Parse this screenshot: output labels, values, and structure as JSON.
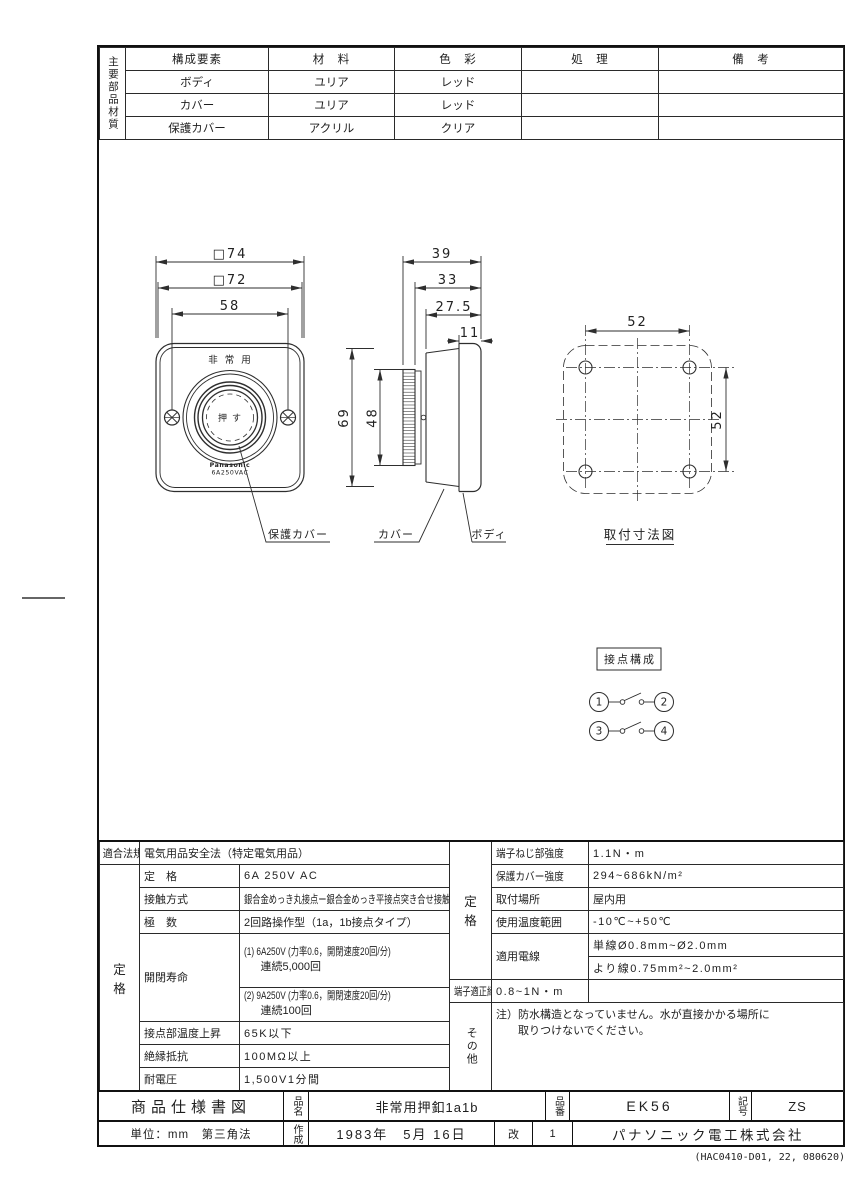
{
  "materials_table": {
    "side_label": "主要部品材質",
    "headers": [
      "構成要素",
      "材　料",
      "色　彩",
      "処　理",
      "備　考"
    ],
    "rows": [
      {
        "component": "ボディ",
        "material": "ユリア",
        "color": "レッド",
        "treatment": "",
        "remarks": ""
      },
      {
        "component": "カバー",
        "material": "ユリア",
        "color": "レッド",
        "treatment": "",
        "remarks": ""
      },
      {
        "component": "保護カバー",
        "material": "アクリル",
        "color": "クリア",
        "treatment": "",
        "remarks": ""
      }
    ]
  },
  "drawing": {
    "front": {
      "dim_outer": "□74",
      "dim_inner": "□72",
      "dim_screws": "58",
      "dim_height": "69",
      "dim_knob": "48",
      "top_label": "非常用",
      "button_label": "押す",
      "brand": "Panasonic",
      "rating": "6A250VAC"
    },
    "side": {
      "dim_total": "39",
      "dim_mid": "33",
      "dim_cover": "27.5",
      "dim_body": "11"
    },
    "part_labels": {
      "protective_cover": "保護カバー",
      "cover": "カバー",
      "body": "ボディ"
    },
    "mounting": {
      "title": "取付寸法図",
      "dim_x": "52",
      "dim_y": "52"
    },
    "contact": {
      "title": "接点構成",
      "t1": "1",
      "t2": "2",
      "t3": "3",
      "t4": "4"
    }
  },
  "spec_left": {
    "law_label": "適合法規",
    "law_value": "電気用品安全法（特定電気用品）",
    "group_top": "定",
    "group_bottom": "格",
    "rows": {
      "rating": {
        "label": "定　格",
        "value": "6A 250V AC"
      },
      "contact_method": {
        "label": "接触方式",
        "value": "銀合金めっき丸接点ー銀合金めっき平接点突き合せ接触"
      },
      "poles": {
        "label": "極　数",
        "value": "2回路操作型（1a，1b接点タイプ）"
      },
      "life": {
        "label": "開閉寿命",
        "v1_line1": "(1) 6A250V (力率0.6，開閉速度20回/分)",
        "v1_line2": "連続5,000回",
        "v2_line1": "(2) 9A250V (力率0.6，開閉速度20回/分)",
        "v2_line2": "連続100回"
      },
      "temp_rise": {
        "label": "接点部温度上昇",
        "value": "65K以下"
      },
      "insulation": {
        "label": "絶縁抵抗",
        "value": "100MΩ以上"
      },
      "withstand": {
        "label": "耐電圧",
        "value": "1,500V1分間"
      }
    }
  },
  "spec_right": {
    "group_top": "定",
    "group_bottom": "格",
    "other_label": "その他",
    "rows": {
      "screw_strength": {
        "label": "端子ねじ部強度",
        "value": "1.1N・m"
      },
      "cover_strength": {
        "label": "保護カバー強度",
        "value": "294~686kN/m²"
      },
      "location": {
        "label": "取付場所",
        "value": "屋内用"
      },
      "temp_range": {
        "label": "使用温度範囲",
        "value": "-10℃~+50℃"
      },
      "wire": {
        "label": "適用電線",
        "value_line1": "単線Ø0.8mm~Ø2.0mm",
        "value_line2": "より線0.75mm²~2.0mm²"
      },
      "torque": {
        "label": "端子適正締付トルク",
        "value": "0.8~1N・m"
      }
    },
    "note_line1": "注）防水構造となっていません。水が直接かかる場所に",
    "note_line2": "取りつけないでください。"
  },
  "title_block": {
    "doc_type": "商品仕様書図",
    "name_label": "品名",
    "name_value": "非常用押釦1a1b",
    "number_label": "品番",
    "number_value": "EK56",
    "symbol_label": "記号",
    "symbol_value": "ZS",
    "unit": "単位：mm　第三角法",
    "created_label": "作成",
    "created_value": "1983年　5月 16日",
    "rev_label": "改",
    "rev_value": "1",
    "company": "パナソニック電工株式会社"
  },
  "footer_note": "(HAC0410-D01, 22, 080620)"
}
